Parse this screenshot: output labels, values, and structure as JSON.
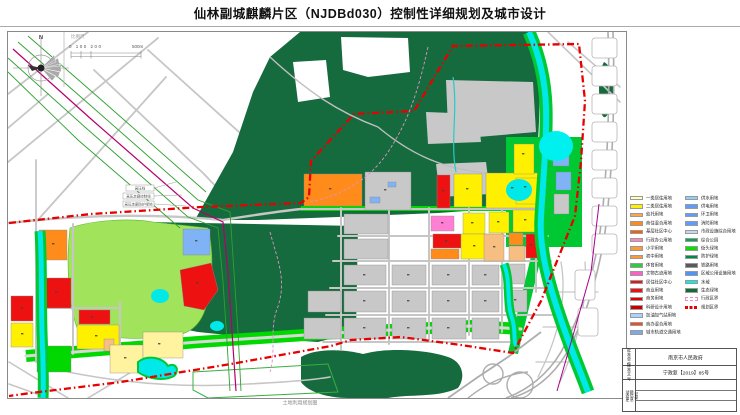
{
  "title": "仙林副城麒麟片区（NJDBd030）控制性详细规划及城市设计",
  "map": {
    "north_label": "N",
    "scale_label": "比例尺",
    "scale_ticks": "0 100 200",
    "scale_end_label": "500m",
    "caption": "土地利用规划图",
    "corridor_labels": [
      "高压线",
      "高压走廊控制线",
      "高压走廊防护绿地"
    ],
    "boundary_color": "#E80000",
    "water_color": "#00E8E8",
    "forest_color": "#156B3D"
  },
  "legend": {
    "left": [
      {
        "label": "一类居住用地",
        "color": "#FFFFB8",
        "kind": "fill"
      },
      {
        "label": "二类居住用地",
        "color": "#FFF000",
        "kind": "fill"
      },
      {
        "label": "幼托用地",
        "color": "#FFA64D",
        "kind": "fill"
      },
      {
        "label": "商住混合用地",
        "color": "#FF8C1A",
        "kind": "fill"
      },
      {
        "label": "基层社区中心",
        "color": "#FF5A00",
        "kind": "fill"
      },
      {
        "label": "行政办公用地",
        "color": "#FF85C2",
        "kind": "fill"
      },
      {
        "label": "小学用地",
        "color": "#FF9933",
        "kind": "fill"
      },
      {
        "label": "初中用地",
        "color": "#FF9933",
        "kind": "fill"
      },
      {
        "label": "体育用地",
        "color": "#2ECC40",
        "kind": "fill"
      },
      {
        "label": "文物古迹用地",
        "color": "#FF5FC8",
        "kind": "fill"
      },
      {
        "label": "居住社区中心",
        "color": "#EE1111",
        "kind": "fill"
      },
      {
        "label": "商业用地",
        "color": "#EE1111",
        "kind": "fill"
      },
      {
        "label": "商务用地",
        "color": "#E00000",
        "kind": "fill"
      },
      {
        "label": "科研设计用地",
        "color": "#C80000",
        "kind": "fill"
      },
      {
        "label": "加油加气站用地",
        "color": "#A8D2FF",
        "kind": "fill"
      },
      {
        "label": "商办混合用地",
        "color": "#FF4719",
        "kind": "fill"
      },
      {
        "label": "城市轨道交通用地",
        "color": "#7FA8E8",
        "kind": "fill"
      }
    ],
    "right": [
      {
        "label": "供水用地",
        "color": "#8CD2FF",
        "kind": "fill"
      },
      {
        "label": "供电用地",
        "color": "#5C9DFF",
        "kind": "fill"
      },
      {
        "label": "环卫用地",
        "color": "#5C9DFF",
        "kind": "fill"
      },
      {
        "label": "消防用地",
        "color": "#5C9DFF",
        "kind": "fill"
      },
      {
        "label": "市政设施综合用地",
        "color": "#C2D9F0",
        "kind": "fill"
      },
      {
        "label": "综合公园",
        "color": "#00A650",
        "kind": "fill"
      },
      {
        "label": "街头绿地",
        "color": "#00E400",
        "kind": "fill"
      },
      {
        "label": "防护绿地",
        "color": "#008C46",
        "kind": "fill"
      },
      {
        "label": "铁路用地",
        "color": "#5A5A5A",
        "kind": "fill"
      },
      {
        "label": "区域公用设施用地",
        "color": "#4D94FF",
        "kind": "fill"
      },
      {
        "label": "水域",
        "color": "#00F0F0",
        "kind": "fill"
      },
      {
        "label": "生态绿地",
        "color": "#0E6E38",
        "kind": "fill"
      },
      {
        "label": "行政区界",
        "color": "#F08AC8",
        "kind": "admin-boundary"
      },
      {
        "label": "规划区界",
        "color": "#E80000",
        "kind": "plan-boundary"
      }
    ]
  },
  "title_block": {
    "rows": [
      {
        "label": "批准单位",
        "value": "南京市人民政府"
      },
      {
        "label": "批准文号",
        "value": "宁政复【2019】85号"
      }
    ],
    "update_label": "动态更新信息记录"
  }
}
